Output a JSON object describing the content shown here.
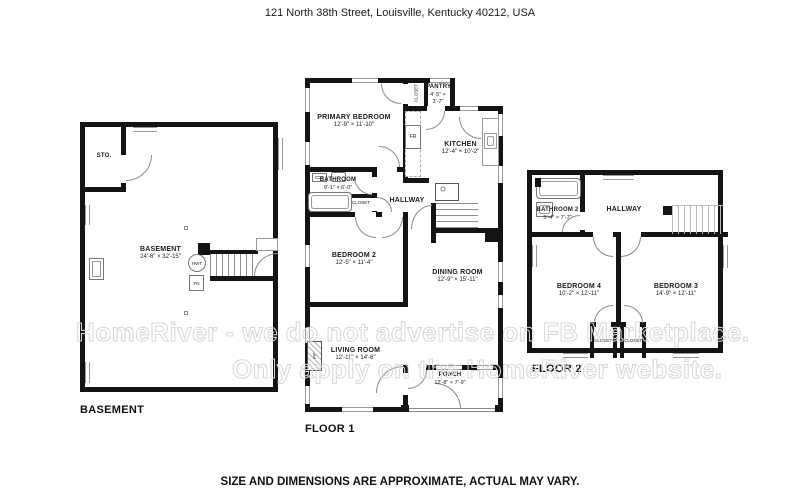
{
  "header": {
    "address": "121 North 38th Street, Louisville, Kentucky 40212, USA"
  },
  "footer": {
    "disclaimer": "SIZE AND DIMENSIONS ARE APPROXIMATE, ACTUAL MAY VARY."
  },
  "watermark": {
    "line1": "HomeRiver - we do not advertise on FB Marketplace.",
    "line2": "Only apply on the HomeRiver website."
  },
  "colors": {
    "wall": "#141414",
    "window_line": "#9a9a9a",
    "watermark": "#d7d7d7"
  },
  "floors": {
    "basement": {
      "label": "BASEMENT",
      "rooms": {
        "basement": {
          "name": "BASEMENT",
          "dims": "24'-6\" × 32'-15\""
        },
        "storage": {
          "name": "STO."
        }
      },
      "fixtures": {
        "hwt": "HWT",
        "fn": "FN"
      }
    },
    "floor1": {
      "label": "FLOOR 1",
      "rooms": {
        "primary_bedroom": {
          "name": "PRIMARY BEDROOM",
          "dims": "12'-9\" × 11'-10\""
        },
        "closet_top": {
          "name": "CLOSET"
        },
        "pantry": {
          "name": "PANTRY",
          "dims": "4'-5\" × 3'-7\""
        },
        "kitchen": {
          "name": "KITCHEN",
          "dims": "12'-4\" × 10'-2\""
        },
        "bathroom": {
          "name": "BATHROOM",
          "dims": "9'-1\" × 6'-0\""
        },
        "closet_hall": {
          "name": "CLOSET"
        },
        "hallway": {
          "name": "HALLWAY"
        },
        "bedroom2": {
          "name": "BEDROOM 2",
          "dims": "12'-5\" × 11'-4\""
        },
        "dining": {
          "name": "DINING ROOM",
          "dims": "12'-9\" × 15'-11\""
        },
        "living": {
          "name": "LIVING ROOM",
          "dims": "12'-11\" × 14'-6\""
        },
        "porch": {
          "name": "PORCH",
          "dims": "12'-8\" × 7'-9\""
        }
      },
      "fixtures": {
        "fr": "FR",
        "fp": "FP"
      }
    },
    "floor2": {
      "label": "FLOOR 2",
      "rooms": {
        "bathroom2": {
          "name": "BATHROOM 2",
          "dims": "5'-4\" × 7'-7\""
        },
        "hallway": {
          "name": "HALLWAY"
        },
        "bedroom4": {
          "name": "BEDROOM 4",
          "dims": "10'-2\" × 12'-11\""
        },
        "bedroom3": {
          "name": "BEDROOM 3",
          "dims": "14'-9\" × 12'-11\""
        },
        "closet_left": {
          "name": "CLOSET"
        },
        "closet_right": {
          "name": "CLOSET"
        }
      }
    }
  }
}
